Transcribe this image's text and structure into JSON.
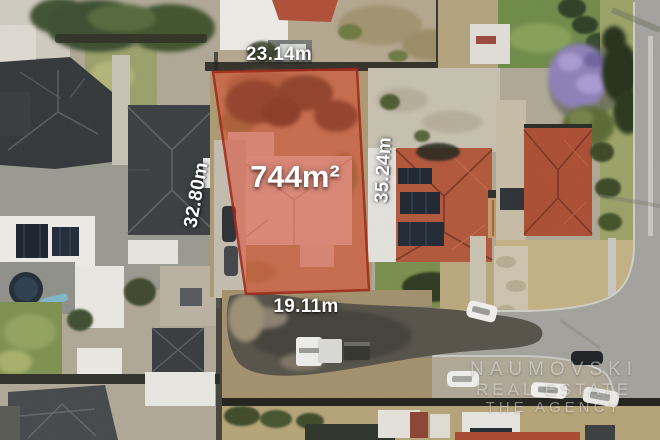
{
  "lot": {
    "area_label": "744m²",
    "dim_top": "23.14m",
    "dim_left": "32.80m",
    "dim_right": "35.24m",
    "dim_bottom": "19.11m",
    "highlight_color": "#e04028",
    "border_color": "#9e2415",
    "label_color": "#ffffff"
  },
  "watermark": {
    "line1": "NAUMOVSKI",
    "line2": "REAL ESTATE",
    "line3": "THE AGENCY"
  }
}
